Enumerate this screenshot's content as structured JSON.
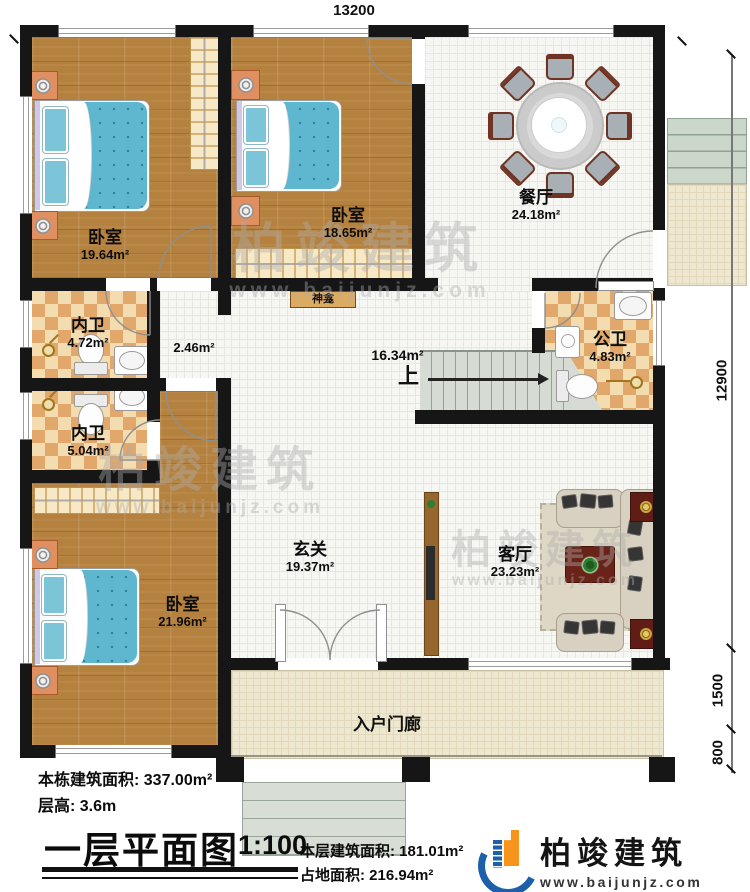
{
  "dimensions": {
    "top": "13200",
    "right": "12900",
    "porch": "1500",
    "steps": "800"
  },
  "rooms": {
    "bedroom1": {
      "name": "卧室",
      "area": "19.64m²"
    },
    "bedroom2": {
      "name": "卧室",
      "area": "18.65m²"
    },
    "bedroom3": {
      "name": "卧室",
      "area": "21.96m²"
    },
    "dining": {
      "name": "餐厅",
      "area": "24.18m²"
    },
    "ensuite1": {
      "name": "内卫",
      "area": "4.72m²"
    },
    "ensuite2": {
      "name": "内卫",
      "area": "5.04m²"
    },
    "public_bath": {
      "name": "公卫",
      "area": "4.83m²"
    },
    "foyer": {
      "name": "玄关",
      "area": "19.37m²"
    },
    "living": {
      "name": "客厅",
      "area": "23.23m²"
    },
    "entry_porch": {
      "name": "入户门廊"
    },
    "corridor_area": "2.46m²",
    "hall_area": "16.34m²",
    "shrine_label": "神龛",
    "stairs_label": "上"
  },
  "title_block": {
    "building_total": "本栋建筑面积: 337.00m²",
    "floor_height": "层高: 3.6m",
    "plan_title": "一层平面图",
    "scale": "1:100",
    "floor_area": "本层建筑面积: 181.01m²",
    "footprint": "占地面积: 216.94m²"
  },
  "logo": {
    "company": "柏竣建筑",
    "website": "www.baijunjz.com"
  },
  "watermark": {
    "text": "柏竣建筑",
    "url": "www.baijunjz.com"
  },
  "colors": {
    "wall": "#161616",
    "wood": "#b5813e",
    "check_a": "#f3ddb0",
    "check_b": "#e2a86b",
    "porch": "#efe8d0",
    "stair": "#d6dcd3",
    "bed_blue": "#5fb6cf",
    "bed_dot": "#2e7f9a",
    "pillow": "#7cc4d8",
    "stand": "#e09060",
    "table_red": "#5f1d15",
    "sofa": "#d8d0c1",
    "rug": "#ded7c5",
    "logo_blue": "#1d5fa8",
    "logo_orange": "#f7941e"
  }
}
